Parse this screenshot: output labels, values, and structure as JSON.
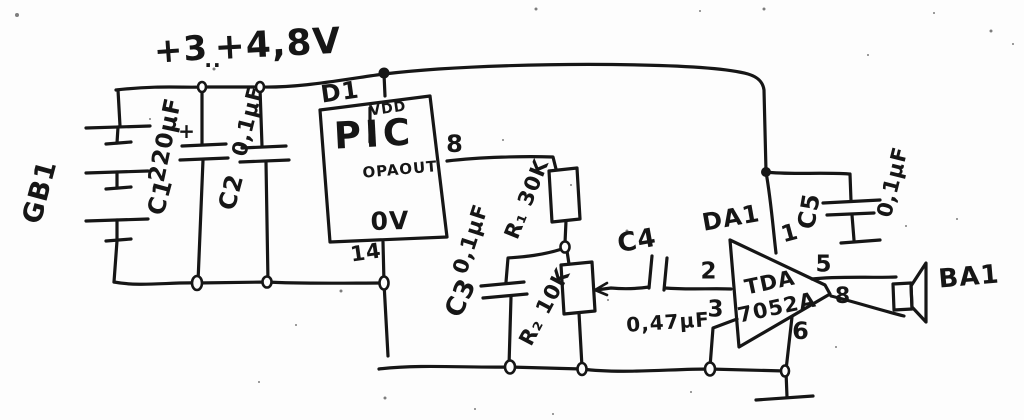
{
  "schematic": {
    "ink_color": "#161616",
    "paper_color": "#fdfdfd",
    "supply": {
      "min": "+3",
      "dots": "..",
      "max": "+4,8V"
    },
    "battery": {
      "ref": "GB1"
    },
    "c1": {
      "ref": "C1",
      "value": "220μF",
      "polarity": "+"
    },
    "c2": {
      "ref": "C2",
      "value": "0,1μF"
    },
    "ic": {
      "ref": "D1",
      "name": "PIC",
      "vdd": "VDD",
      "output": "OPAOUT",
      "ground": "0V",
      "pin_output": "8",
      "pin_ground": "14"
    },
    "r1": {
      "label": "R₁ 30K"
    },
    "r2": {
      "label": "R₂ 10K"
    },
    "c3": {
      "ref": "C3",
      "value": "0,1μF"
    },
    "c4": {
      "ref": "C4",
      "value": "0,47μF"
    },
    "amp": {
      "ref": "DA1",
      "part_line1": "TDA",
      "part_line2": "7052A",
      "pin_in": "2",
      "pin_gnd_sense": "3",
      "pin_svr": "1",
      "pin_gnd": "6",
      "pin_out_plus": "5",
      "pin_out_minus": "8"
    },
    "c5": {
      "ref": "C5",
      "value": "0,1μF"
    },
    "speaker": {
      "ref": "BA1"
    }
  }
}
